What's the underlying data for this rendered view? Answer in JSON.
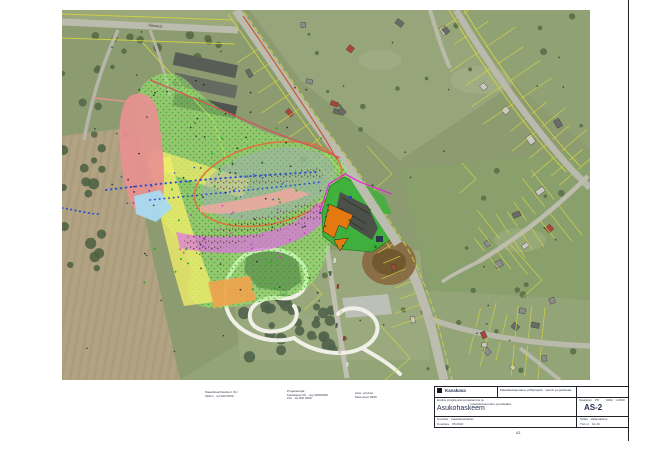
{
  "map": {
    "street_label": "Jaama tn",
    "colors": {
      "zone_grass_green": "#9bee72",
      "zone_yellow": "#f2ee6a",
      "zone_pink": "#e89090",
      "zone_gray": "#a2aeb8",
      "zone_blue": "#a8daf0",
      "zone_magenta": "#e070e6",
      "zone_salmon": "#f0a8a0",
      "zone_orange_building": "#e5790f",
      "zone_bright_green": "#39b23a",
      "boundary_orange": "#e0703a",
      "boundary_red": "#d05858",
      "cadastral_yellow": "#d2d246"
    }
  },
  "notes": {
    "block1": [
      "Maastikuarhitektuur OÜ",
      "Tallinn · tel 000 0000"
    ],
    "block2": [
      "Projekteerija:",
      "Kavakava OÜ · reg 00000000",
      "info · tel 000 0000"
    ],
    "block3": [
      "Alus: ortofoto",
      "Maa-amet 2009"
    ]
  },
  "titleblock": {
    "logo_text": "Kavakava",
    "project_line": "Maastikukujunduse põhiprojekt · spordi- ja puhkeala",
    "object_line1": "Endise prügila ala korrastamine ja",
    "object_line2": "maastikukujundus spordialaks",
    "sheet_title": "Asukohaskeem",
    "stage_label": "Staadium",
    "stage_value": "PP",
    "scale_label": "Mõõt",
    "scale_value": "1:2000",
    "drawing_no": "AS-2",
    "author_line": "Koostas · maastikuarhitekt",
    "date_label": "Kuupäev",
    "date_value": "05.2010",
    "client_label": "Tellija",
    "client_value": "Vallavalitsus",
    "work_label": "Töö nr",
    "work_value": "10-10",
    "format_text": "A3"
  }
}
